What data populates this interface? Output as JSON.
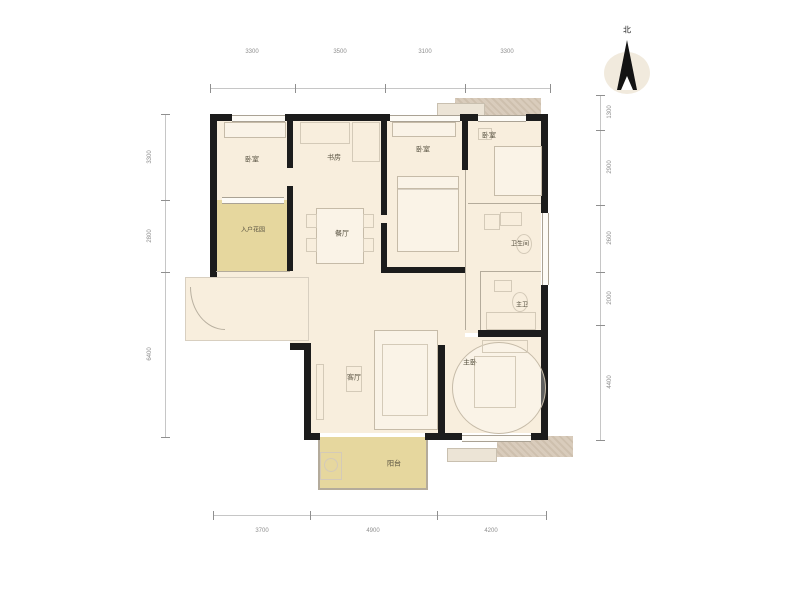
{
  "north": {
    "label": "北"
  },
  "rooms": [
    {
      "name": "bedroom-top-left",
      "label": "卧室"
    },
    {
      "name": "entry-garden",
      "label": "入户花园"
    },
    {
      "name": "study",
      "label": "书房"
    },
    {
      "name": "dining-room",
      "label": "餐厅"
    },
    {
      "name": "bedroom-middle",
      "label": "卧室"
    },
    {
      "name": "bedroom-top-right",
      "label": "卧室"
    },
    {
      "name": "bathroom",
      "label": "卫生间"
    },
    {
      "name": "master-bathroom",
      "label": "主卫"
    },
    {
      "name": "living-room",
      "label": "客厅"
    },
    {
      "name": "master-bedroom",
      "label": "主卧"
    },
    {
      "name": "balcony",
      "label": "阳台"
    }
  ],
  "dimensions": {
    "top": [
      "3300",
      "3500",
      "3100",
      "3300"
    ],
    "bottom": [
      "3700",
      "4900",
      "4200"
    ],
    "left": [
      "3300",
      "2800",
      "6400"
    ],
    "right": [
      "1300",
      "2900",
      "2600",
      "2000",
      "4400"
    ]
  },
  "colors": {
    "floor": "#f8eedd",
    "accent_yellow": "#e6d79e",
    "wall": "#1c1c1c",
    "platform_tan": "#d9ccbc"
  }
}
